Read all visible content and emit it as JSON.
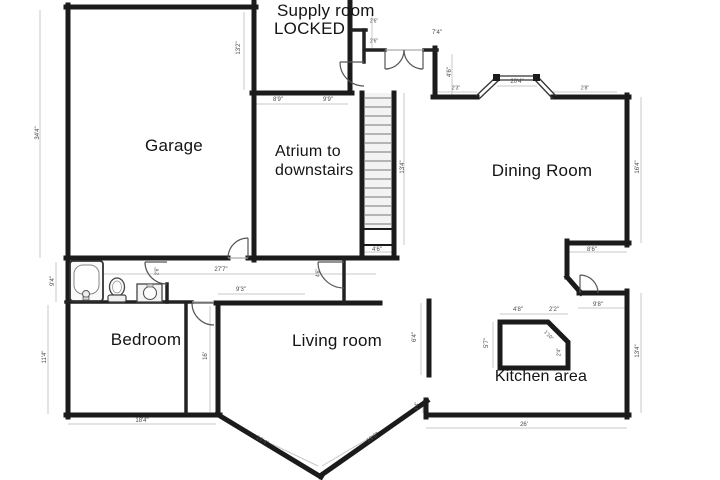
{
  "title": "Upstairs floor plan",
  "colors": {
    "wall": "#1b1b1b",
    "inner_wall": "#222222",
    "dim_line": "#c8c8c8",
    "dim_text": "#4a4a4a",
    "door_arc": "#555555",
    "background": "#ffffff",
    "stair_fill": "#f3f3f3",
    "tread": "#8f8f8f"
  },
  "rooms": [
    {
      "label": "Supply room",
      "x": 277,
      "y": 1,
      "size": 17,
      "align": "left"
    },
    {
      "label": "LOCKED",
      "x": 274,
      "y": 19,
      "size": 17,
      "align": "left"
    },
    {
      "label": "Garage",
      "x": 174,
      "y": 136,
      "size": 17,
      "align": "center"
    },
    {
      "label": "Atrium to",
      "x": 275,
      "y": 143,
      "size": 16,
      "align": "left"
    },
    {
      "label": "downstairs",
      "x": 275,
      "y": 162,
      "size": 16,
      "align": "left"
    },
    {
      "label": "Dining Room",
      "x": 542,
      "y": 161,
      "size": 17,
      "align": "center"
    },
    {
      "label": "Living room",
      "x": 337,
      "y": 331,
      "size": 17,
      "align": "center"
    },
    {
      "label": "Bedroom",
      "x": 146,
      "y": 330,
      "size": 17,
      "align": "center"
    },
    {
      "label": "Kitchen area",
      "x": 541,
      "y": 368,
      "size": 16,
      "align": "center"
    }
  ],
  "dimensions": [
    {
      "label": "34'4\"",
      "x": 38,
      "y": 133,
      "rot": -90,
      "s": 6
    },
    {
      "label": "9'4\"",
      "x": 53,
      "y": 281,
      "rot": -90,
      "s": 6
    },
    {
      "label": "11'4\"",
      "x": 45,
      "y": 357,
      "rot": -90,
      "s": 6
    },
    {
      "label": "27'7\"",
      "x": 221,
      "y": 270,
      "rot": 0,
      "s": 6
    },
    {
      "label": "18'4\"",
      "x": 142,
      "y": 421,
      "rot": 0,
      "s": 6
    },
    {
      "label": "26'",
      "x": 524,
      "y": 425,
      "rot": 0,
      "s": 6
    },
    {
      "label": "13'2\"",
      "x": 239,
      "y": 48,
      "rot": -90,
      "s": 6
    },
    {
      "label": "8'9\"",
      "x": 278,
      "y": 100,
      "rot": 0,
      "s": 6
    },
    {
      "label": "9'9\"",
      "x": 328,
      "y": 100,
      "rot": 0,
      "s": 6
    },
    {
      "label": "13'4\"",
      "x": 403,
      "y": 167,
      "rot": -90,
      "s": 6
    },
    {
      "label": "4'6\"",
      "x": 377,
      "y": 250,
      "rot": 0,
      "s": 6
    },
    {
      "label": "2'6\"",
      "x": 374,
      "y": 22,
      "rot": 0,
      "s": 5
    },
    {
      "label": "2'6\"",
      "x": 374,
      "y": 42,
      "rot": 0,
      "s": 5
    },
    {
      "label": "7'4\"",
      "x": 437,
      "y": 33,
      "rot": 0,
      "s": 6
    },
    {
      "label": "4'6\"",
      "x": 450,
      "y": 72,
      "rot": -90,
      "s": 6
    },
    {
      "label": "2'3\"",
      "x": 456,
      "y": 89,
      "rot": 0,
      "s": 5
    },
    {
      "label": "20'4\"",
      "x": 517,
      "y": 82,
      "rot": 0,
      "s": 6
    },
    {
      "label": "2'8\"",
      "x": 585,
      "y": 89,
      "rot": 0,
      "s": 5
    },
    {
      "label": "16'4\"",
      "x": 638,
      "y": 167,
      "rot": -90,
      "s": 6
    },
    {
      "label": "8'6\"",
      "x": 592,
      "y": 250,
      "rot": 0,
      "s": 6
    },
    {
      "label": "9'8\"",
      "x": 598,
      "y": 305,
      "rot": 0,
      "s": 6
    },
    {
      "label": "13'4\"",
      "x": 638,
      "y": 351,
      "rot": -90,
      "s": 6
    },
    {
      "label": "4'8\"",
      "x": 518,
      "y": 310,
      "rot": 0,
      "s": 6
    },
    {
      "label": "2'2\"",
      "x": 554,
      "y": 310,
      "rot": 0,
      "s": 6
    },
    {
      "label": "5'7\"",
      "x": 487,
      "y": 343,
      "rot": -90,
      "s": 6
    },
    {
      "label": "1'10\"",
      "x": 548,
      "y": 336,
      "rot": 45,
      "s": 5
    },
    {
      "label": "2'4\"",
      "x": 560,
      "y": 352,
      "rot": -90,
      "s": 5
    },
    {
      "label": "9'3\"",
      "x": 241,
      "y": 290,
      "rot": 0,
      "s": 6
    },
    {
      "label": "16'",
      "x": 206,
      "y": 356,
      "rot": -90,
      "s": 6
    },
    {
      "label": "6'4\"",
      "x": 415,
      "y": 337,
      "rot": -90,
      "s": 6
    },
    {
      "label": "4'4\"",
      "x": 418,
      "y": 406,
      "rot": -90,
      "s": 5
    },
    {
      "label": "19'4\"",
      "x": 262,
      "y": 441,
      "rot": 31,
      "s": 6
    },
    {
      "label": "19'6\"",
      "x": 373,
      "y": 438,
      "rot": -35,
      "s": 6
    },
    {
      "label": "2'6\"",
      "x": 158,
      "y": 271,
      "rot": -90,
      "s": 5
    },
    {
      "label": "4'6\"",
      "x": 319,
      "y": 273,
      "rot": -90,
      "s": 5
    }
  ],
  "fixtures": [
    "bathtub",
    "toilet",
    "sink-vanity",
    "staircase",
    "kitchen-island",
    "bay-window",
    "french-doors",
    "door-arcs"
  ]
}
